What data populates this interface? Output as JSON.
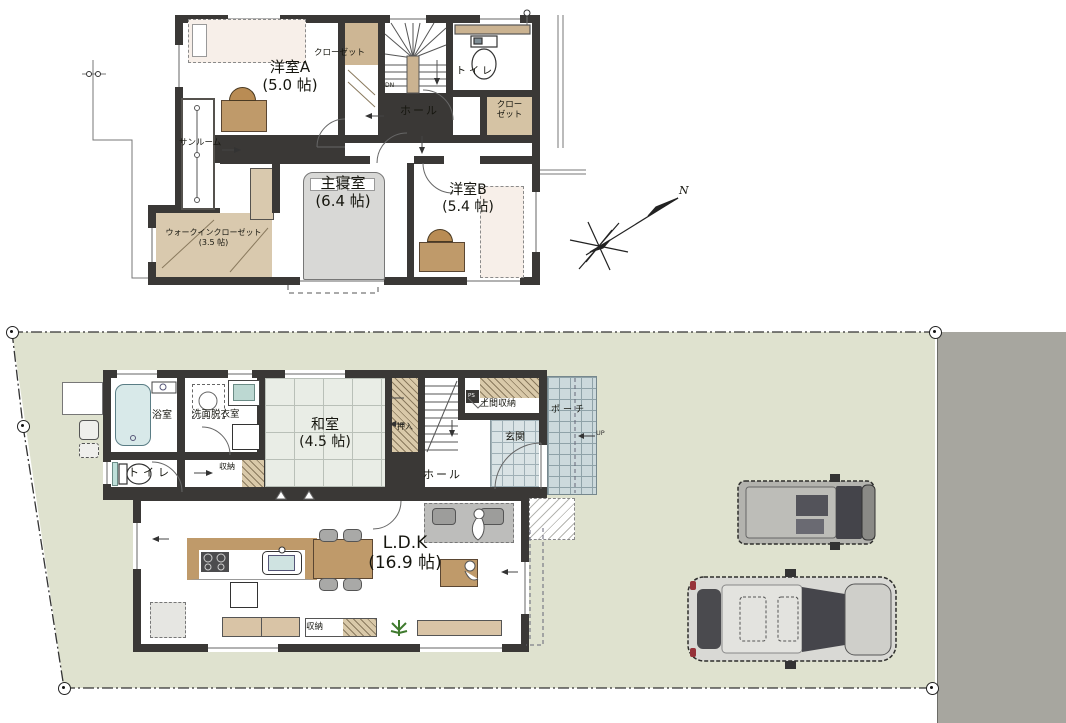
{
  "colors": {
    "site_green": "#dfe2cf",
    "road_gray": "#a7a69f",
    "wall": "#3a3836",
    "tatami": "#e9ede6",
    "wood": "#bf9a6a",
    "tile_porch": "#ccd9dc",
    "bath_tub": "#d8e9e9"
  },
  "compass": {
    "north_label": "N"
  },
  "floor2": {
    "room_a": {
      "name": "洋室A",
      "size": "(5.0 帖)"
    },
    "closet_a": {
      "name": "クローゼット"
    },
    "toilet": {
      "name": "トイレ"
    },
    "hall": {
      "name": "ホール"
    },
    "closet_b": {
      "line1": "クロー",
      "line2": "ゼット"
    },
    "sunroom": {
      "name": "サンルーム"
    },
    "master_bedroom": {
      "name": "主寝室",
      "size": "(6.4 帖)"
    },
    "room_b": {
      "name": "洋室B",
      "size": "(5.4 帖)"
    },
    "walk_in_closet": {
      "name": "ウォークインクローゼット",
      "size": "(3.5 帖)"
    },
    "stairs": {
      "label": "DN"
    }
  },
  "floor1": {
    "bath": {
      "name": "浴室"
    },
    "washroom": {
      "name": "洗面脱衣室"
    },
    "toilet": {
      "name": "トイレ"
    },
    "hall_storage": {
      "name": "収納"
    },
    "washitsu": {
      "name": "和室",
      "size": "(4.5 帖)"
    },
    "oshiire": {
      "name": "押入"
    },
    "doma_storage": {
      "name": "土間収納"
    },
    "genkan": {
      "name": "玄関"
    },
    "porch": {
      "name": "ポーチ"
    },
    "hall": {
      "name": "ホール"
    },
    "ldk": {
      "name": "L.D.K",
      "size": "(16.9 帖)"
    },
    "ldk_storage": {
      "name": "収納"
    },
    "pipe_space": {
      "name": "PS"
    },
    "stairs": {
      "label": "UP"
    }
  }
}
